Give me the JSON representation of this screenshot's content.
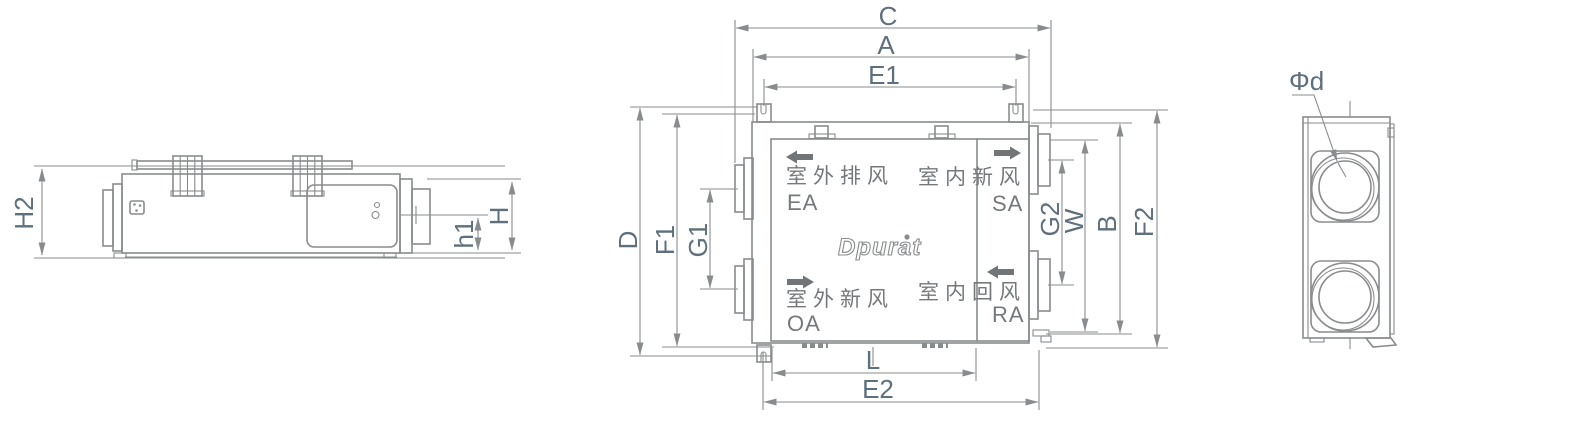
{
  "drawing": {
    "brand": "Dpurat",
    "brand_mark": "●",
    "side_view": {
      "h2": "H2",
      "h1": "h1",
      "h": "H"
    },
    "plan_view": {
      "c": "C",
      "a": "A",
      "e1": "E1",
      "d": "D",
      "f1": "F1",
      "g1": "G1",
      "g2": "G2",
      "w": "W",
      "b": "B",
      "f2": "F2",
      "l": "L",
      "e2": "E2",
      "ports": {
        "ea": {
          "name": "室外排风",
          "code": "EA"
        },
        "sa": {
          "name": "室内新风",
          "code": "SA"
        },
        "oa": {
          "name": "室外新风",
          "code": "OA"
        },
        "ra": {
          "name": "室内回风",
          "code": "RA"
        }
      }
    },
    "end_view": {
      "phi_d": "Φd"
    }
  },
  "colors": {
    "line": "#898c8e",
    "dim_label": "#5e6f7e",
    "cjk_text": "#75797c",
    "flow_arrow": "#717578"
  }
}
